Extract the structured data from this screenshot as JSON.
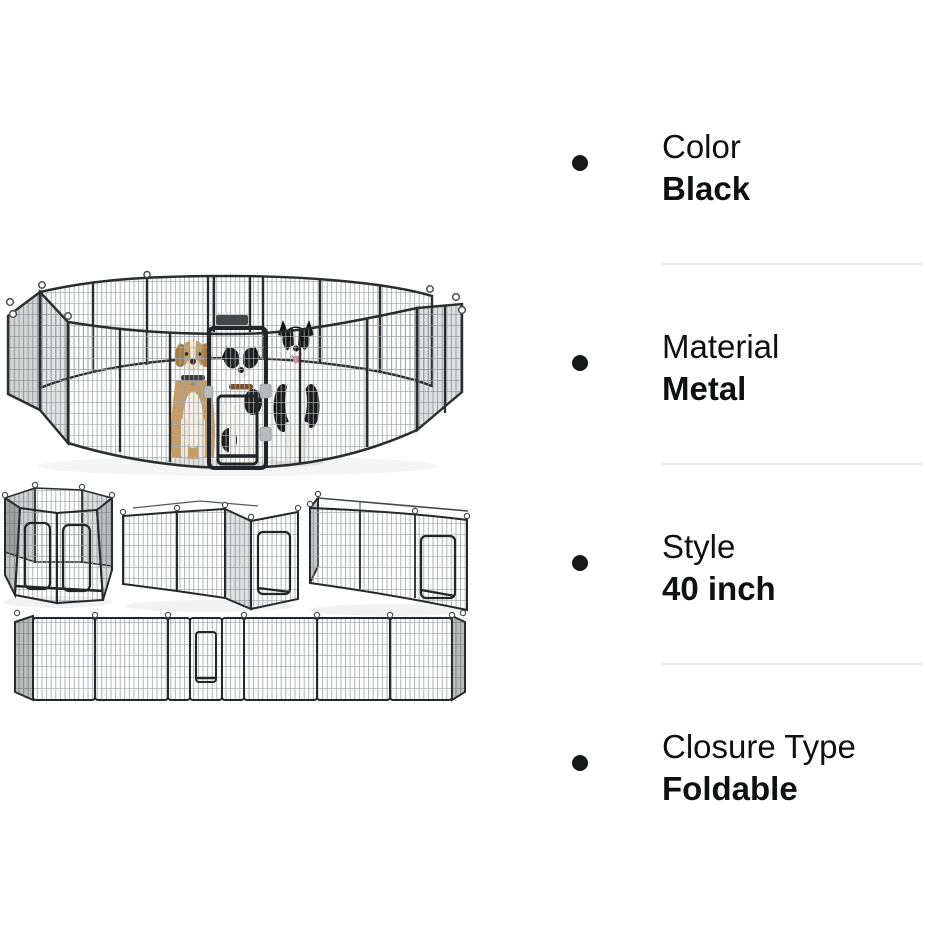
{
  "page": {
    "background": "#ffffff",
    "text_color": "#0f1111",
    "divider_color": "#e7e7e7"
  },
  "product_image": {
    "description": "Black metal foldable dog playpen shown assembled as a 16-panel ring with three dogs inside, folded into hexagon, L-shape and rectangle pens, and laid out flat"
  },
  "attributes": {
    "items": [
      {
        "label": "Color",
        "value": "Black"
      },
      {
        "label": "Material",
        "value": "Metal"
      },
      {
        "label": "Style",
        "value": "40 inch"
      },
      {
        "label": "Closure Type",
        "value": "Foldable"
      }
    ]
  }
}
